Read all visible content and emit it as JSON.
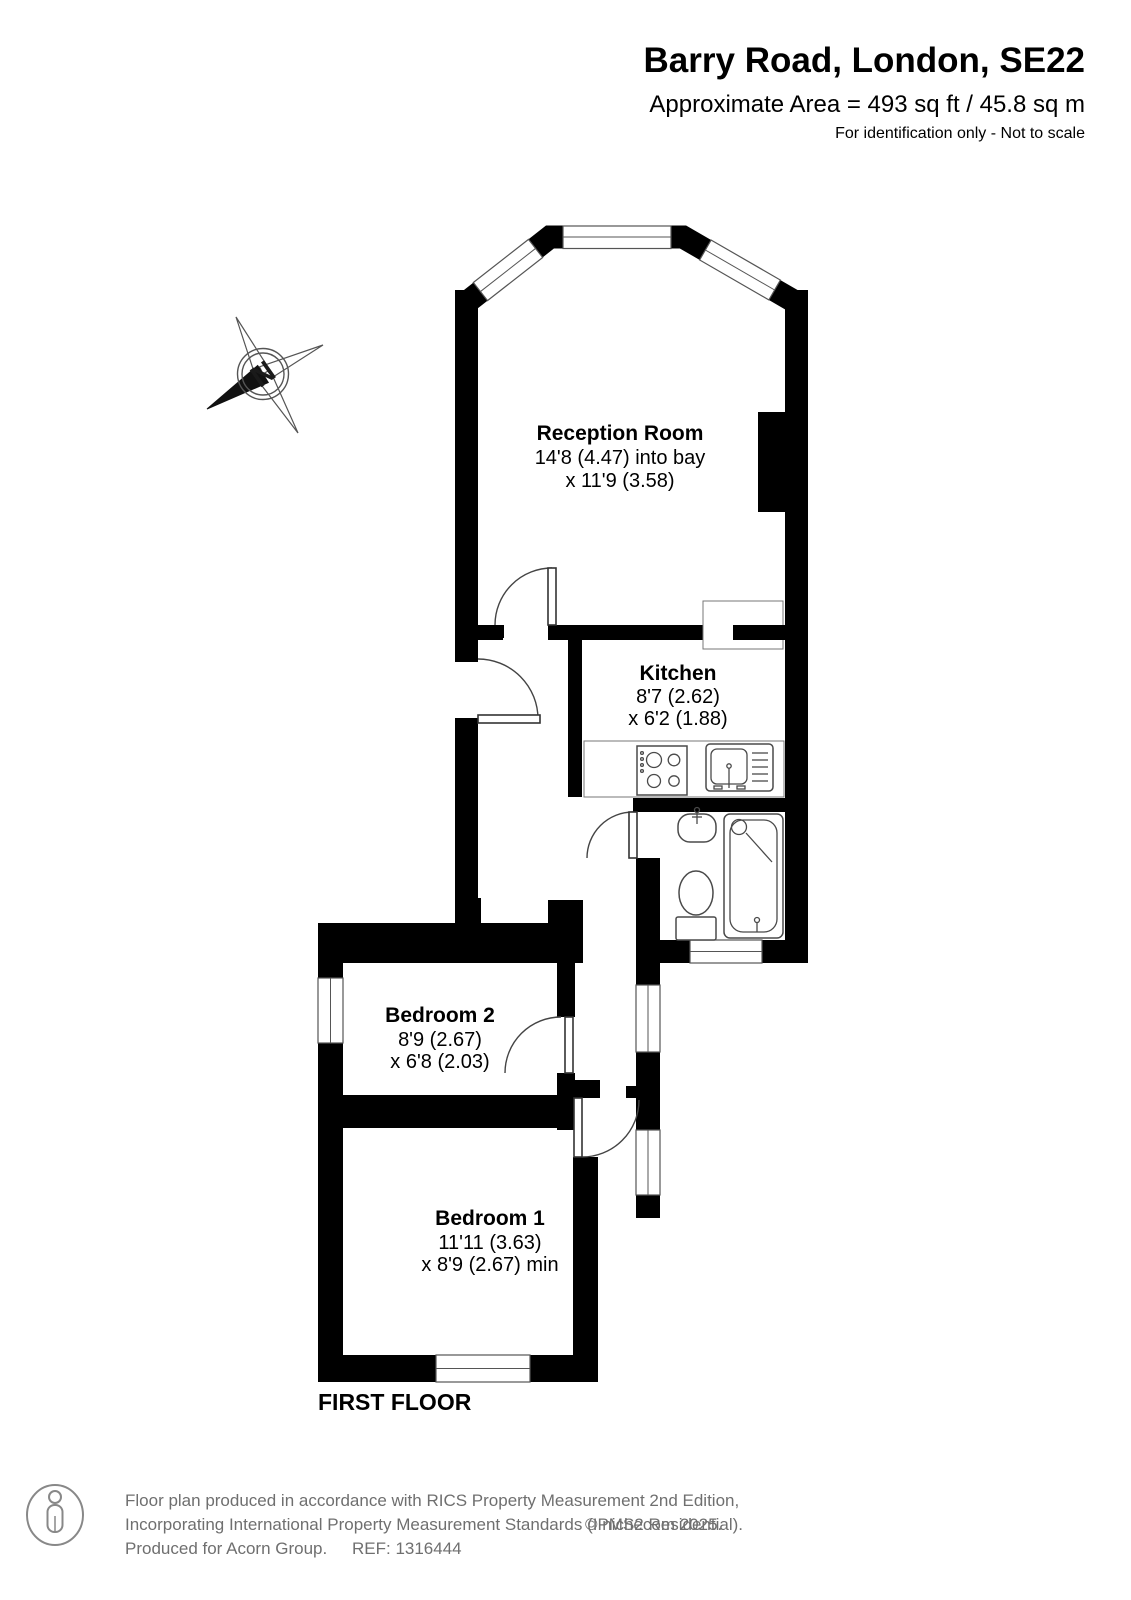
{
  "header": {
    "title": "Barry Road, London, SE22",
    "area": "Approximate Area = 493 sq ft / 45.8 sq m",
    "disclaimer": "For identification only - Not to scale"
  },
  "compass": {
    "north_label": "N"
  },
  "rooms": {
    "reception": {
      "name": "Reception Room",
      "dim1": "14'8 (4.47) into bay",
      "dim2": "x 11'9 (3.58)"
    },
    "kitchen": {
      "name": "Kitchen",
      "dim1": "8'7 (2.62)",
      "dim2": "x 6'2 (1.88)"
    },
    "bedroom2": {
      "name": "Bedroom 2",
      "dim1": "8'9 (2.67)",
      "dim2": "x 6'8 (2.03)"
    },
    "bedroom1": {
      "name": "Bedroom 1",
      "dim1": "11'11 (3.63)",
      "dim2": "x 8'9 (2.67) min"
    }
  },
  "floor_label": "FIRST FLOOR",
  "footer": {
    "line1": "Floor plan produced in accordance with RICS Property Measurement 2nd Edition,",
    "line2": "Incorporating International Property Measurement Standards (IPMS2 Residential).",
    "copyright": "© nichecom 2025.",
    "line3": "Produced for Acorn Group.",
    "ref": "REF: 1316444"
  },
  "colors": {
    "wall": "#000000",
    "detail_line": "#4a4a4a",
    "footer_text": "#6f6f6f"
  }
}
